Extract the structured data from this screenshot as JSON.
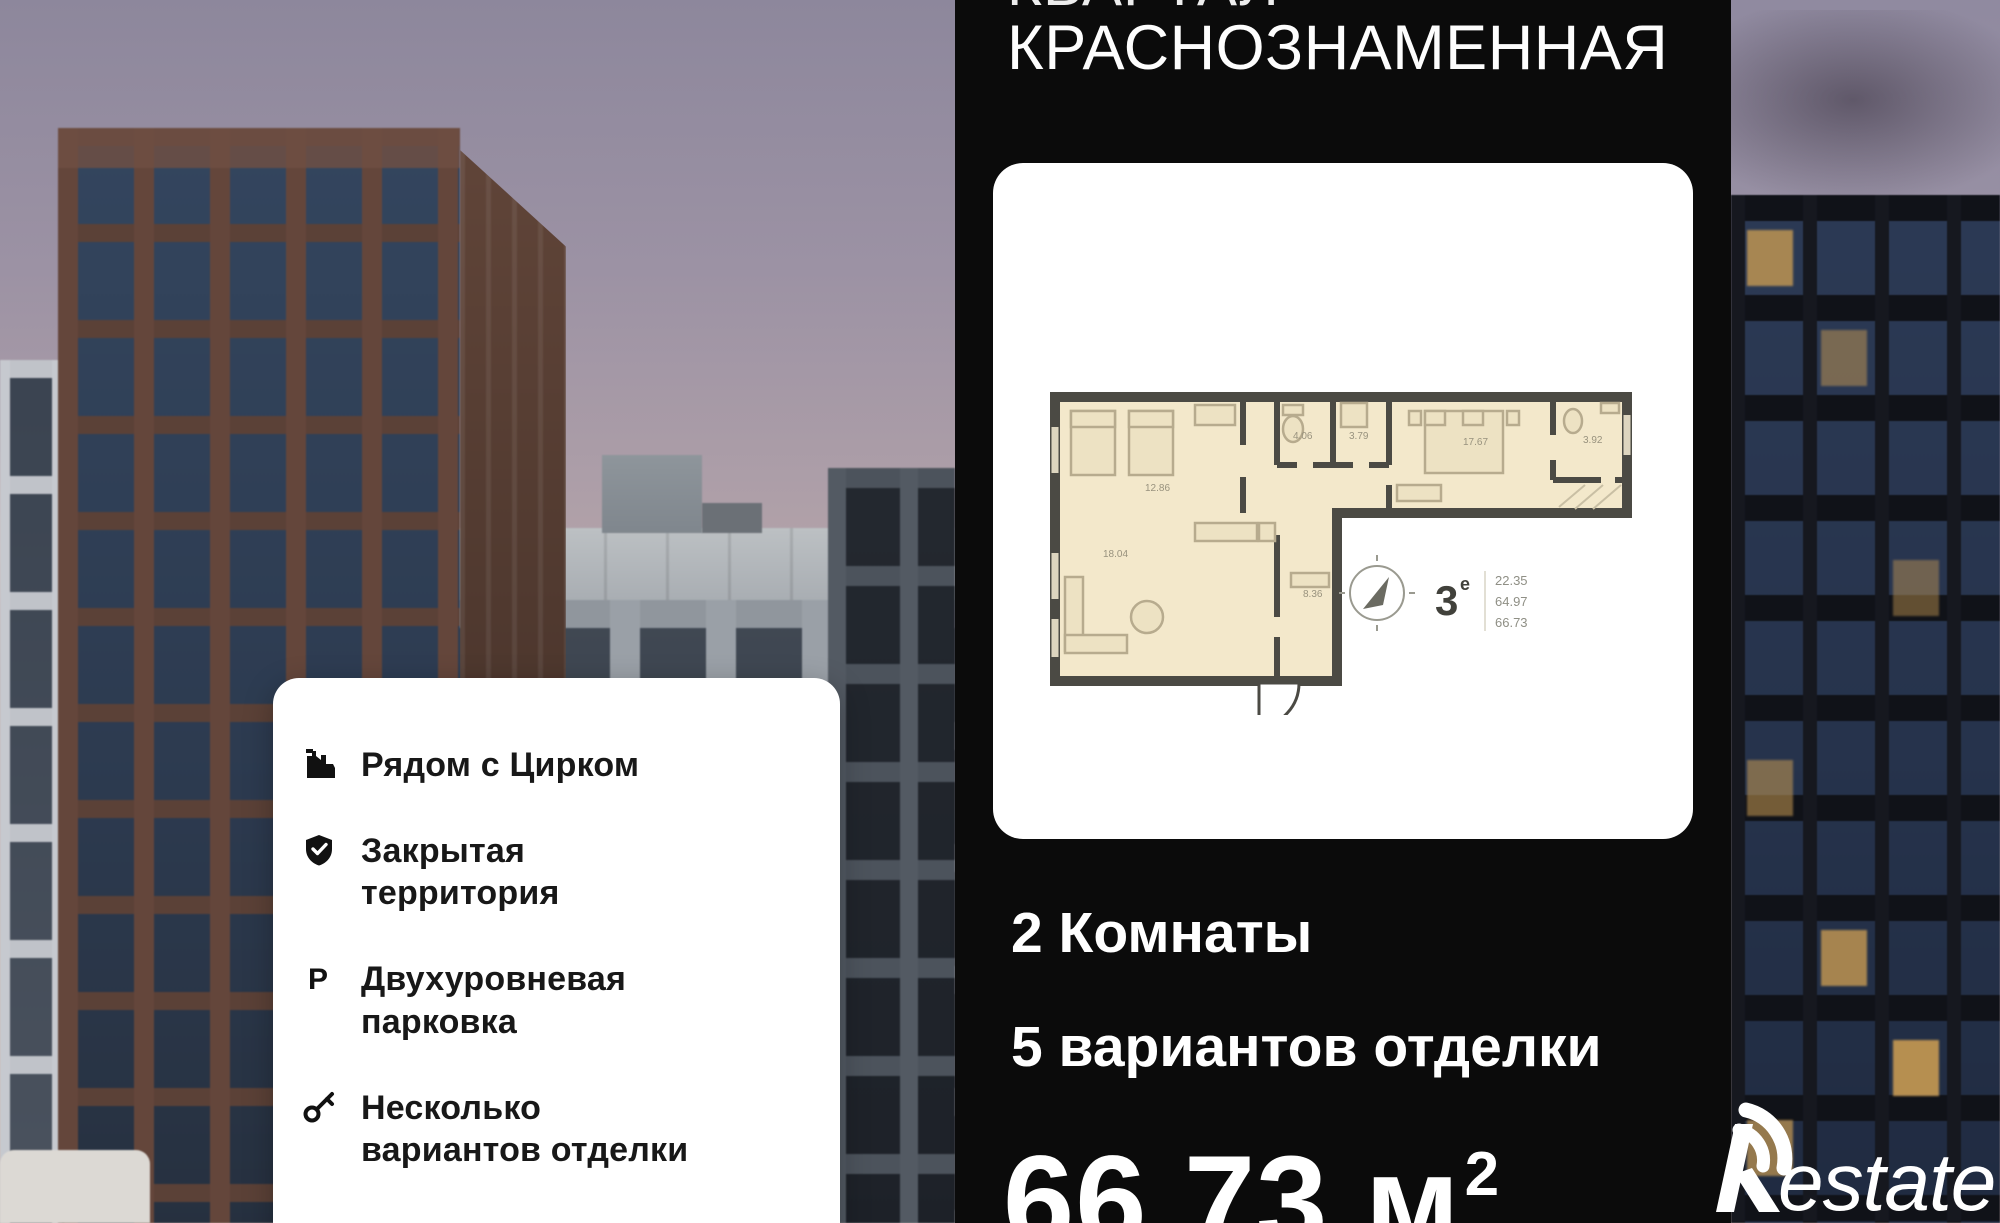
{
  "headline": {
    "clipped_top_word": "КВАРТАЛ",
    "title": "КРАСНОЗНАМЕННАЯ"
  },
  "listing": {
    "rooms": "2 Комнаты",
    "finish": "5 вариантов отделки",
    "area": "66.73",
    "area_unit": "м",
    "area_exponent": "2"
  },
  "features": {
    "items": [
      {
        "icon": "circus-building-icon",
        "label": "Рядом с Цирком"
      },
      {
        "icon": "shield-check-icon",
        "label": "Закрытая территория"
      },
      {
        "icon": "parking-icon",
        "label": "Двухуровневая парковка"
      },
      {
        "icon": "key-icon",
        "label": "Несколько вариантов отделки"
      }
    ]
  },
  "floor_plan": {
    "type_number": "3",
    "type_suffix": "е",
    "stats": [
      "22.35",
      "64.97",
      "66.73"
    ],
    "rooms": {
      "bedroom_left": "12.86",
      "bathroom": "4.06",
      "wc": "3.79",
      "bedroom_right": "17.67",
      "bathroom_2": "3.92",
      "living": "18.04",
      "hall": "8.36"
    }
  },
  "brand": {
    "name": "Restate",
    "logo_text": "estate"
  },
  "colors": {
    "panel_black": "#0b0b0b",
    "card_white": "#ffffff",
    "feature_text": "#181818",
    "plan_room_fill": "#f3e8cb",
    "plan_wall": "#4b4a44",
    "lit_window": "#c79a52",
    "sky_top": "#8d879c",
    "sky_bottom": "#ccb4ae"
  }
}
